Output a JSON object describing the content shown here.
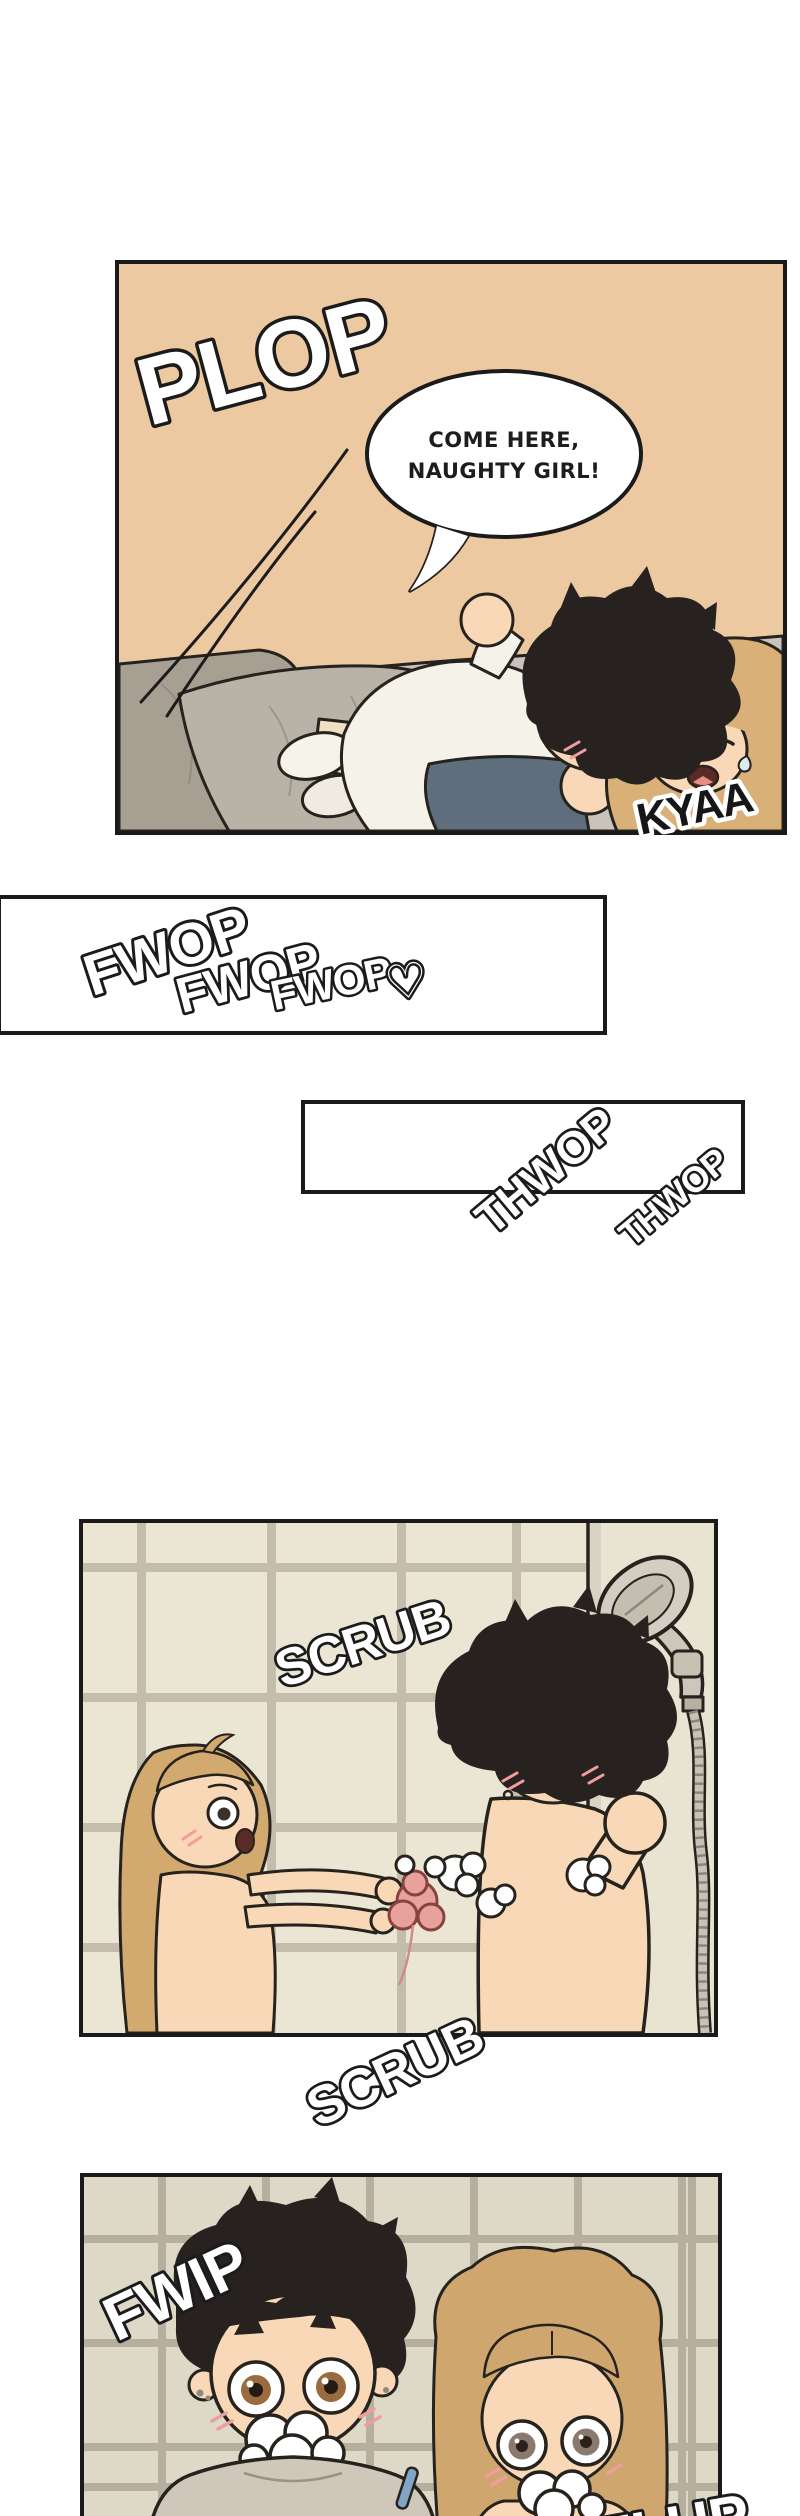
{
  "comic": {
    "panel1": {
      "sfx_plop": "PLOP",
      "bubble_line1": "COME HERE,",
      "bubble_line2": "NAUGHTY GIRL!",
      "sfx_kyaa": "KYAA"
    },
    "panel2": {
      "sfx": [
        "FWOP",
        "FWOP",
        "FWOP"
      ],
      "heart": "♡"
    },
    "panel3": {
      "sfx": [
        "THWOP",
        "THWOP"
      ]
    },
    "panel4": {
      "sfx_scrub_inside": "SCRUB",
      "sfx_scrub_below": "SCRUB"
    },
    "panel5": {
      "sfx_fwip": "FWIP",
      "sfx_flup_partial": "FLUP"
    }
  },
  "colors": {
    "page_bg": "#ffffff",
    "panel_border": "#1a1a1a",
    "bedroom_bg": "#edc9a1",
    "bed_gray": "#c9c4b9",
    "pillow_gray": "#a89f93",
    "blanket_gray": "#b9b3a7",
    "skin": "#f8d8b7",
    "blush": "#ef9d9d",
    "boy_hair": "#272220",
    "girl_hair_bed": "#d8b078",
    "girl_hair_shower": "#cfa76e",
    "shirt_white": "#f5f2ea",
    "shorts_slate": "#5e6e7d",
    "tile_light": "#ebe6d4",
    "grout_light": "#c4bdac",
    "tile_dark": "#ded8c6",
    "grout_dark": "#b7af9d",
    "shower_metal": "#cbc7ba",
    "loofah_pink": "#e9a19e",
    "boy_iris": "#9a6b3f",
    "girl_iris": "#8a796c",
    "shirt_taupe": "#cfc8ba"
  }
}
